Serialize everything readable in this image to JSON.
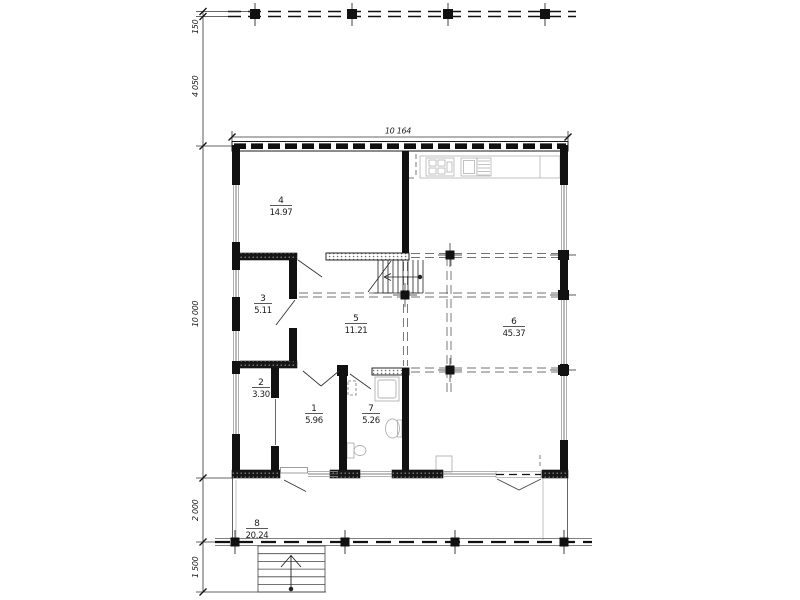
{
  "plan": {
    "rooms": [
      {
        "number": "4",
        "area": "14.97"
      },
      {
        "number": "3",
        "area": "5.11"
      },
      {
        "number": "5",
        "area": "11.21"
      },
      {
        "number": "6",
        "area": "45.37"
      },
      {
        "number": "2",
        "area": "3.30"
      },
      {
        "number": "1",
        "area": "5.96"
      },
      {
        "number": "7",
        "area": "5.26"
      },
      {
        "number": "8",
        "area": "20.24"
      }
    ],
    "dimensions": {
      "top_width": "10 164",
      "left_height": "10 000",
      "balcony_band": "150",
      "balcony_offset": "4 050",
      "terrace_depth": "2 000",
      "entry_stairs_depth": "1 500"
    },
    "colors": {
      "ink": "#1a1a1a",
      "fixture_gray": "#b3b3b3",
      "thin_gray": "#8a8a8a"
    }
  }
}
